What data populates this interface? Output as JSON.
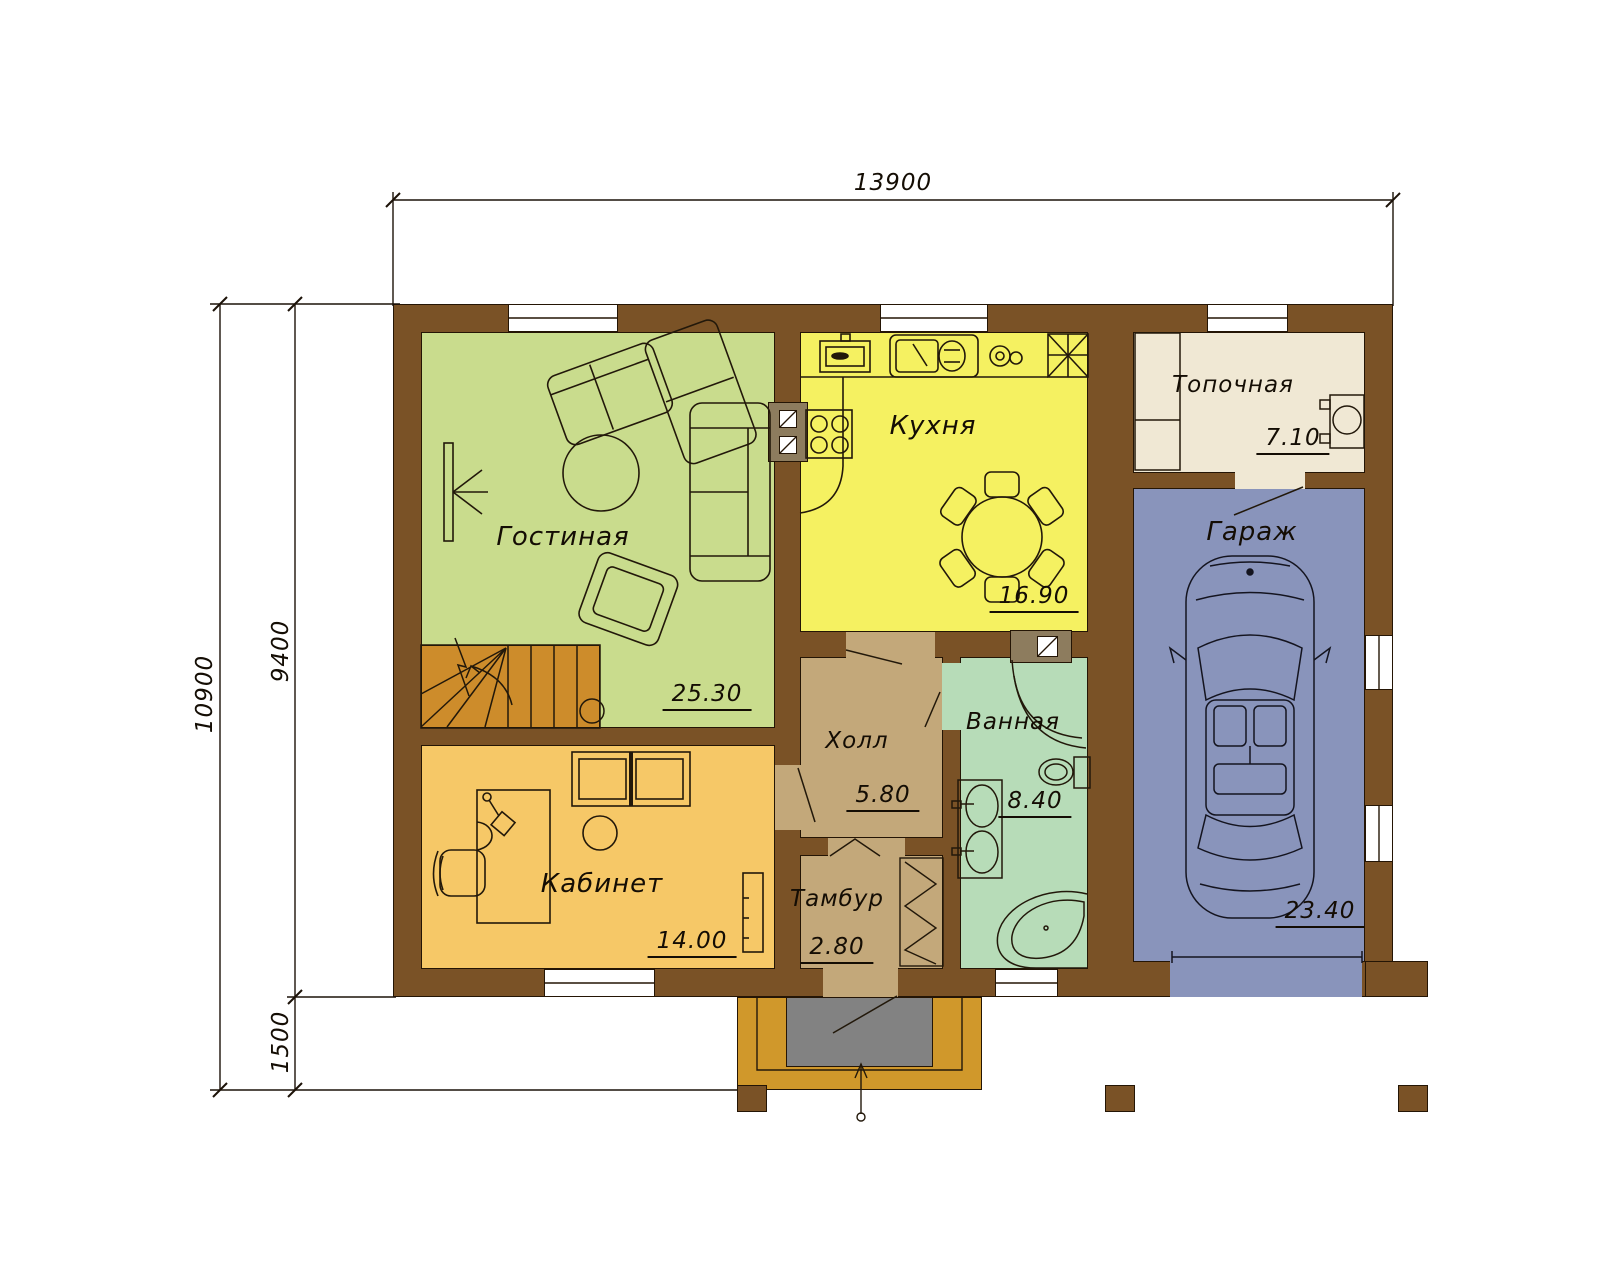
{
  "dimensions": {
    "width_total": "13900",
    "height_total": "10900",
    "height_main": "9400",
    "porch_depth": "1500"
  },
  "rooms": [
    {
      "name": "Гостиная",
      "area": "25.30"
    },
    {
      "name": "Кухня",
      "area": "16.90"
    },
    {
      "name": "Топочная",
      "area": "7.10"
    },
    {
      "name": "Гараж",
      "area": "23.40"
    },
    {
      "name": "Кабинет",
      "area": "14.00"
    },
    {
      "name": "Холл",
      "area": "5.80"
    },
    {
      "name": "Ванная",
      "area": "8.40"
    },
    {
      "name": "Тамбур",
      "area": "2.80"
    }
  ],
  "colors": {
    "wall": "#7a5226",
    "living": "#c9dc8d",
    "kitchen": "#f5f161",
    "office": "#f6c867",
    "hall": "#c3a87a",
    "bath": "#b7dcb8",
    "garage": "#8994bb",
    "boiler": "#f0e8d4",
    "stairs": "#cd8c2b",
    "porch": "#d0982b",
    "landing": "#828282",
    "vent": "#8d7c5e",
    "line": "#1c1208"
  }
}
